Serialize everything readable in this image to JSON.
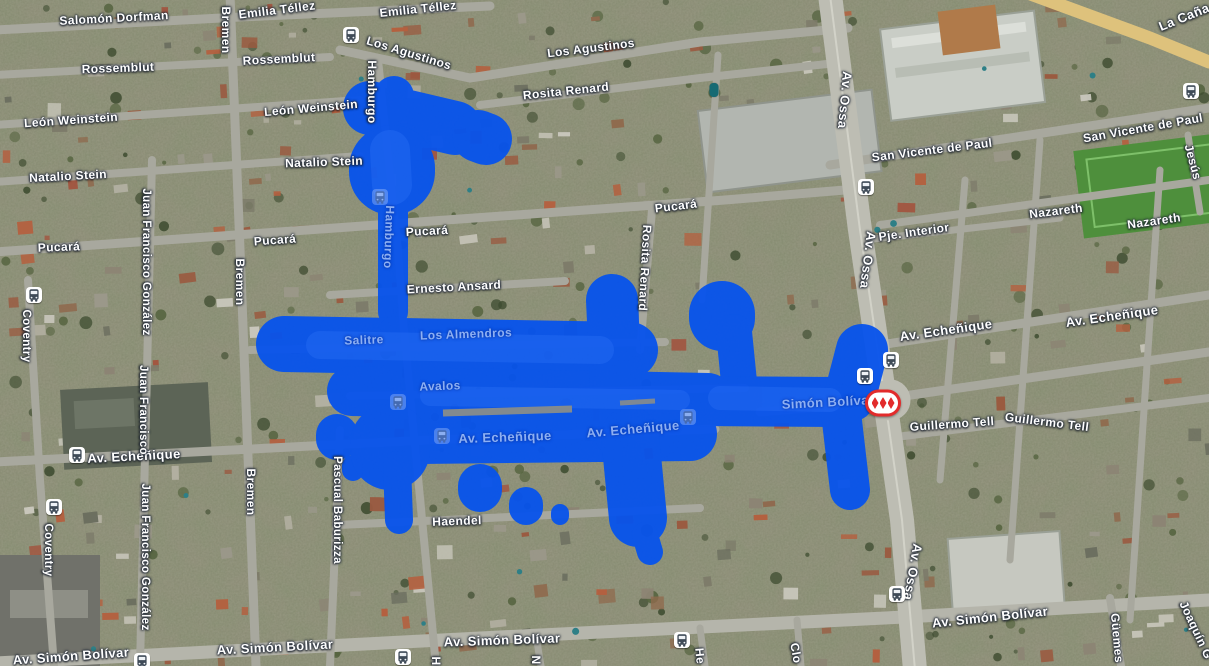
{
  "map": {
    "overlay_color": "#0753ec",
    "overlay_light_color": "#2e72f7",
    "metro_red": "#e22b2b",
    "bus_glyph_color": "#3f4b58",
    "street_labels": [
      {
        "text": "Salomón Dorfman",
        "x": 114,
        "y": 18,
        "rot": -3,
        "size": 12,
        "variant": "normal"
      },
      {
        "text": "Emilia Téllez",
        "x": 277,
        "y": 10,
        "rot": -7,
        "size": 12,
        "variant": "normal"
      },
      {
        "text": "Emilia Téllez",
        "x": 418,
        "y": 9,
        "rot": -6,
        "size": 12,
        "variant": "normal"
      },
      {
        "text": "Rossemblut",
        "x": 118,
        "y": 68,
        "rot": -2,
        "size": 12,
        "variant": "normal"
      },
      {
        "text": "Rossemblut",
        "x": 279,
        "y": 59,
        "rot": -3,
        "size": 12,
        "variant": "normal"
      },
      {
        "text": "León Weinstein",
        "x": 71,
        "y": 120,
        "rot": -4,
        "size": 12,
        "variant": "normal"
      },
      {
        "text": "León Weinstein",
        "x": 311,
        "y": 108,
        "rot": -5,
        "size": 12,
        "variant": "normal"
      },
      {
        "text": "Natalio Stein",
        "x": 68,
        "y": 176,
        "rot": -3,
        "size": 12,
        "variant": "normal"
      },
      {
        "text": "Natalio Stein",
        "x": 324,
        "y": 162,
        "rot": -2,
        "size": 12,
        "variant": "normal"
      },
      {
        "text": "Los Agustinos",
        "x": 409,
        "y": 53,
        "rot": 17,
        "size": 12,
        "variant": "normal"
      },
      {
        "text": "Los Agustinos",
        "x": 591,
        "y": 48,
        "rot": -7,
        "size": 12,
        "variant": "normal"
      },
      {
        "text": "Rosita Renard",
        "x": 566,
        "y": 91,
        "rot": -6,
        "size": 12,
        "variant": "normal"
      },
      {
        "text": "Pucará",
        "x": 59,
        "y": 247,
        "rot": -2,
        "size": 12,
        "variant": "normal"
      },
      {
        "text": "Pucará",
        "x": 275,
        "y": 240,
        "rot": -4,
        "size": 12,
        "variant": "normal"
      },
      {
        "text": "Pucará",
        "x": 427,
        "y": 231,
        "rot": -3,
        "size": 12,
        "variant": "normal"
      },
      {
        "text": "Pucará",
        "x": 676,
        "y": 206,
        "rot": -7,
        "size": 12,
        "variant": "normal"
      },
      {
        "text": "Ernesto Ansard",
        "x": 454,
        "y": 287,
        "rot": -3,
        "size": 12,
        "variant": "normal"
      },
      {
        "text": "Av. Echeñique",
        "x": 134,
        "y": 456,
        "rot": -3,
        "size": 13,
        "variant": "normal"
      },
      {
        "text": "Av. Echeñique",
        "x": 505,
        "y": 437,
        "rot": -2,
        "size": 13,
        "variant": "under_blue"
      },
      {
        "text": "Av. Echeñique",
        "x": 633,
        "y": 429,
        "rot": -5,
        "size": 13,
        "variant": "under_blue"
      },
      {
        "text": "Av. Echeñique",
        "x": 946,
        "y": 330,
        "rot": -8,
        "size": 13,
        "variant": "normal"
      },
      {
        "text": "Av. Echeñique",
        "x": 1112,
        "y": 316,
        "rot": -8,
        "size": 13,
        "variant": "normal"
      },
      {
        "text": "Pje. Interior",
        "x": 914,
        "y": 232,
        "rot": -8,
        "size": 12,
        "variant": "normal"
      },
      {
        "text": "Nazareth",
        "x": 1056,
        "y": 211,
        "rot": -7,
        "size": 12,
        "variant": "normal"
      },
      {
        "text": "Nazareth",
        "x": 1154,
        "y": 221,
        "rot": -8,
        "size": 12,
        "variant": "normal"
      },
      {
        "text": "San Vicente de Paul",
        "x": 932,
        "y": 150,
        "rot": -7,
        "size": 12,
        "variant": "normal"
      },
      {
        "text": "San Vicente de Paul",
        "x": 1143,
        "y": 128,
        "rot": -10,
        "size": 12,
        "variant": "normal"
      },
      {
        "text": "La Caña",
        "x": 1184,
        "y": 17,
        "rot": -22,
        "size": 13,
        "variant": "normal"
      },
      {
        "text": "Guillermo Tell",
        "x": 952,
        "y": 424,
        "rot": -4,
        "size": 12,
        "variant": "normal"
      },
      {
        "text": "Guillermo Tell",
        "x": 1047,
        "y": 422,
        "rot": 7,
        "size": 12,
        "variant": "normal"
      },
      {
        "text": "Simón Bolívar",
        "x": 828,
        "y": 402,
        "rot": -3,
        "size": 13,
        "variant": "under_blue"
      },
      {
        "text": "Av. Simón Bolívar",
        "x": 71,
        "y": 656,
        "rot": -4,
        "size": 13,
        "variant": "normal"
      },
      {
        "text": "Av. Simón Bolívar",
        "x": 275,
        "y": 647,
        "rot": -3,
        "size": 13,
        "variant": "normal"
      },
      {
        "text": "Av. Simón Bolívar",
        "x": 502,
        "y": 640,
        "rot": -2,
        "size": 13,
        "variant": "normal"
      },
      {
        "text": "Av. Simón Bolívar",
        "x": 990,
        "y": 617,
        "rot": -6,
        "size": 13,
        "variant": "normal"
      },
      {
        "text": "Haendel",
        "x": 457,
        "y": 521,
        "rot": -2,
        "size": 12,
        "variant": "normal"
      },
      {
        "text": "Salitre",
        "x": 364,
        "y": 340,
        "rot": -2,
        "size": 12,
        "variant": "under_blue"
      },
      {
        "text": "Los Almendros",
        "x": 466,
        "y": 334,
        "rot": -2,
        "size": 12,
        "variant": "under_blue"
      },
      {
        "text": "Avalos",
        "x": 440,
        "y": 386,
        "rot": -2,
        "size": 12,
        "variant": "under_blue"
      },
      {
        "text": "Bremen",
        "x": 226,
        "y": 30,
        "rot": 90,
        "size": 12,
        "variant": "normal"
      },
      {
        "text": "Bremen",
        "x": 240,
        "y": 282,
        "rot": 90,
        "size": 12,
        "variant": "normal"
      },
      {
        "text": "Bremen",
        "x": 251,
        "y": 492,
        "rot": 90,
        "size": 12,
        "variant": "normal"
      },
      {
        "text": "Hamburgo",
        "x": 372,
        "y": 92,
        "rot": 90,
        "size": 12,
        "variant": "normal"
      },
      {
        "text": "Hamburgo",
        "x": 389,
        "y": 237,
        "rot": 92,
        "size": 12,
        "variant": "under_blue"
      },
      {
        "text": "Juan Francisco González",
        "x": 146,
        "y": 262,
        "rot": 90,
        "size": 11.5,
        "variant": "normal"
      },
      {
        "text": "Juan Francisco",
        "x": 143,
        "y": 410,
        "rot": 90,
        "size": 11.5,
        "variant": "normal"
      },
      {
        "text": "Juan Francisco González",
        "x": 145,
        "y": 557,
        "rot": 90,
        "size": 11.5,
        "variant": "normal"
      },
      {
        "text": "Coventry",
        "x": 26,
        "y": 336,
        "rot": 90,
        "size": 11.5,
        "variant": "normal"
      },
      {
        "text": "Coventry",
        "x": 48,
        "y": 550,
        "rot": 90,
        "size": 11.5,
        "variant": "normal"
      },
      {
        "text": "Pascual Baburizza",
        "x": 337,
        "y": 510,
        "rot": 90,
        "size": 11.5,
        "variant": "normal"
      },
      {
        "text": "Rosita Renard",
        "x": 645,
        "y": 268,
        "rot": 93,
        "size": 12,
        "variant": "normal"
      },
      {
        "text": "Av. Ossa",
        "x": 845,
        "y": 100,
        "rot": 95,
        "size": 13,
        "variant": "normal"
      },
      {
        "text": "Av. Ossa",
        "x": 868,
        "y": 260,
        "rot": 97,
        "size": 13,
        "variant": "normal"
      },
      {
        "text": "Av. Ossa",
        "x": 913,
        "y": 572,
        "rot": 100,
        "size": 13,
        "variant": "normal"
      },
      {
        "text": "Jesús",
        "x": 1193,
        "y": 162,
        "rot": 75,
        "size": 12,
        "variant": "normal"
      },
      {
        "text": "Güemes",
        "x": 1117,
        "y": 638,
        "rot": 85,
        "size": 12,
        "variant": "normal"
      },
      {
        "text": "Joaquín G",
        "x": 1196,
        "y": 630,
        "rot": 65,
        "size": 12,
        "variant": "normal"
      },
      {
        "text": "H",
        "x": 436,
        "y": 661,
        "rot": 90,
        "size": 12,
        "variant": "normal"
      },
      {
        "text": "N",
        "x": 536,
        "y": 660,
        "rot": 90,
        "size": 12,
        "variant": "normal"
      },
      {
        "text": "He",
        "x": 700,
        "y": 656,
        "rot": 85,
        "size": 12,
        "variant": "normal"
      },
      {
        "text": "Clo",
        "x": 796,
        "y": 653,
        "rot": 80,
        "size": 12,
        "variant": "normal"
      }
    ],
    "transit_icons": [
      {
        "kind": "bus-stop-icon",
        "x": 351,
        "y": 35,
        "variant": "normal"
      },
      {
        "kind": "bus-stop-icon",
        "x": 34,
        "y": 295,
        "variant": "normal"
      },
      {
        "kind": "bus-stop-icon",
        "x": 77,
        "y": 455,
        "variant": "normal"
      },
      {
        "kind": "bus-stop-icon",
        "x": 54,
        "y": 507,
        "variant": "normal"
      },
      {
        "kind": "bus-stop-icon",
        "x": 142,
        "y": 661,
        "variant": "normal"
      },
      {
        "kind": "bus-stop-icon",
        "x": 403,
        "y": 657,
        "variant": "normal"
      },
      {
        "kind": "bus-stop-icon",
        "x": 682,
        "y": 640,
        "variant": "normal"
      },
      {
        "kind": "bus-stop-icon",
        "x": 897,
        "y": 594,
        "variant": "normal"
      },
      {
        "kind": "bus-stop-icon",
        "x": 866,
        "y": 187,
        "variant": "normal"
      },
      {
        "kind": "bus-stop-icon",
        "x": 891,
        "y": 360,
        "variant": "normal"
      },
      {
        "kind": "bus-stop-icon",
        "x": 865,
        "y": 376,
        "variant": "normal"
      },
      {
        "kind": "bus-stop-icon",
        "x": 1191,
        "y": 91,
        "variant": "normal"
      },
      {
        "kind": "bus-stop-icon",
        "x": 380,
        "y": 197,
        "variant": "under_blue"
      },
      {
        "kind": "bus-stop-icon",
        "x": 398,
        "y": 402,
        "variant": "under_blue"
      },
      {
        "kind": "bus-stop-icon",
        "x": 442,
        "y": 436,
        "variant": "under_blue"
      },
      {
        "kind": "bus-stop-icon",
        "x": 688,
        "y": 417,
        "variant": "under_blue"
      }
    ],
    "metro_station": {
      "kind": "metro-station-icon",
      "x": 883,
      "y": 403
    },
    "poi_icons": [
      {
        "kind": "poi-teal-icon",
        "x": 714,
        "y": 90
      }
    ]
  }
}
